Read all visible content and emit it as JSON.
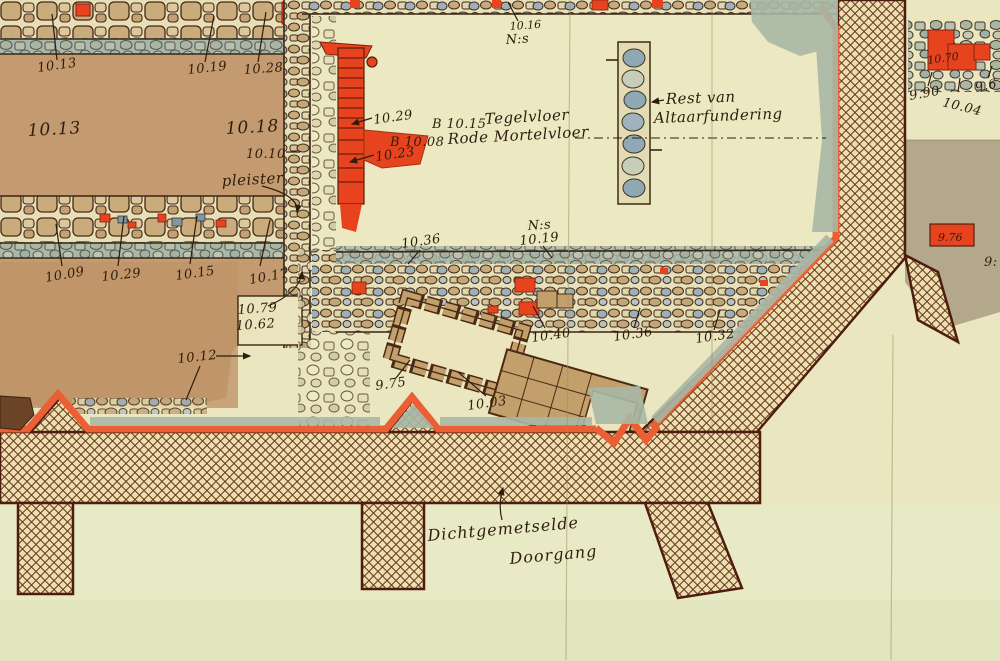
{
  "meta": {
    "kind": "hand-drawn archaeological excavation plan (colored scan)",
    "language": "Dutch"
  },
  "palette": {
    "paper_cream": "#e9e6c0",
    "room_brown": "#c49a70",
    "stone_tan": "#c9ab7c",
    "stone_blue_gray": "#8fa8b4",
    "accent_red": "#e8431f",
    "hatch_brown": "#6a3a1e",
    "wall_border_maroon": "#4f1d0e",
    "edge_orange": "#ea5f33",
    "band_sage": "#a8b8a6",
    "right_tan": "#b4a88c",
    "ink": "#2e1d0d"
  },
  "annotations": {
    "pleister": "pleister",
    "nis_top_value": "10.16",
    "nis_top": "N:s",
    "tile_floor_prefix": "B 10.15",
    "tile_floor": "Tegelvloer",
    "mortar_floor_prefix": "B 10.08",
    "mortar_floor": "Rode Mortelvloer",
    "altar_rest_line1": "Rest van",
    "altar_rest_line2": "Altaarfundering",
    "nis_mid": "N:s",
    "nis_mid_value": "10.19",
    "passage_line1": "Dichtgemetselde",
    "passage_line2": "Doorgang"
  },
  "elevations": [
    {
      "text": "10.13"
    },
    {
      "text": "10.19"
    },
    {
      "text": "10.28"
    },
    {
      "text": "10.13"
    },
    {
      "text": "10.18"
    },
    {
      "text": "10.10"
    },
    {
      "text": "10.09"
    },
    {
      "text": "10.29"
    },
    {
      "text": "10.15"
    },
    {
      "text": "10.17"
    },
    {
      "text": "10.79"
    },
    {
      "text": "10.62"
    },
    {
      "text": "10.12"
    },
    {
      "text": "10.29"
    },
    {
      "text": "10.23"
    },
    {
      "text": "10.36"
    },
    {
      "text": "10.40"
    },
    {
      "text": "10.36"
    },
    {
      "text": "10.32"
    },
    {
      "text": "9.75"
    },
    {
      "text": "10.03"
    },
    {
      "text": "9.90"
    },
    {
      "text": "10.04"
    },
    {
      "text": "9.6"
    },
    {
      "text": "10.70"
    },
    {
      "text": "9.76"
    },
    {
      "text": "9:"
    }
  ]
}
